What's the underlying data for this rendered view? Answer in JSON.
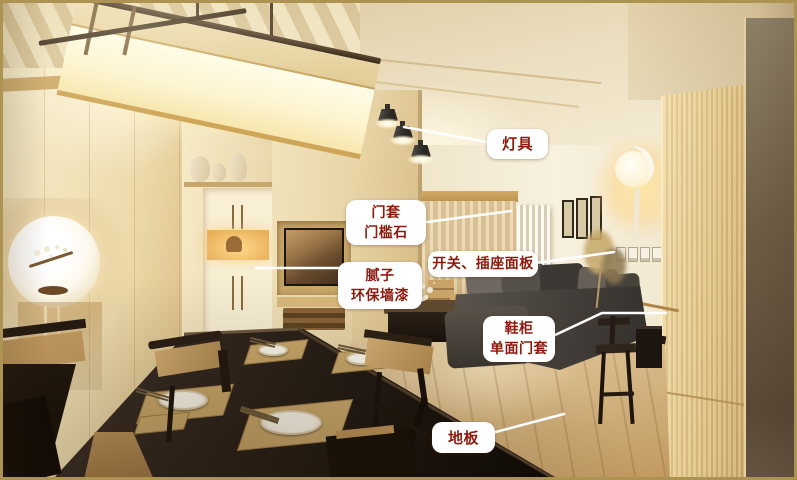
{
  "annotations": {
    "label_background": "#ffffff",
    "label_text_color": "#8e1a0e",
    "line_color": "#ffffff",
    "items": [
      {
        "id": "lamp",
        "points_to": "ceiling-spotlights",
        "lines": [
          "灯具"
        ]
      },
      {
        "id": "door-casing",
        "points_to": "door-casing-threshold",
        "lines": [
          "门套",
          "门槛石"
        ]
      },
      {
        "id": "putty-paint",
        "points_to": "wall-surface",
        "lines": [
          "腻子",
          "环保墙漆"
        ]
      },
      {
        "id": "switch-socket",
        "points_to": "socket-panels",
        "lines": [
          "开关、插座面板"
        ]
      },
      {
        "id": "shoe-cabinet",
        "points_to": "shoe-cabinet",
        "lines": [
          "鞋柜",
          "单面门套"
        ]
      },
      {
        "id": "floor",
        "points_to": "wood-floor",
        "lines": [
          "地板"
        ]
      }
    ]
  },
  "photo": {
    "border_color": "#ad9352",
    "palette": {
      "ceiling": "#ecdfc0",
      "walls": "#f2e4bd",
      "wood_floor": "#d2b384",
      "dining_table": "#22180f",
      "sofa": "#4a453f",
      "accent_glow": "#ffe9b0"
    }
  }
}
